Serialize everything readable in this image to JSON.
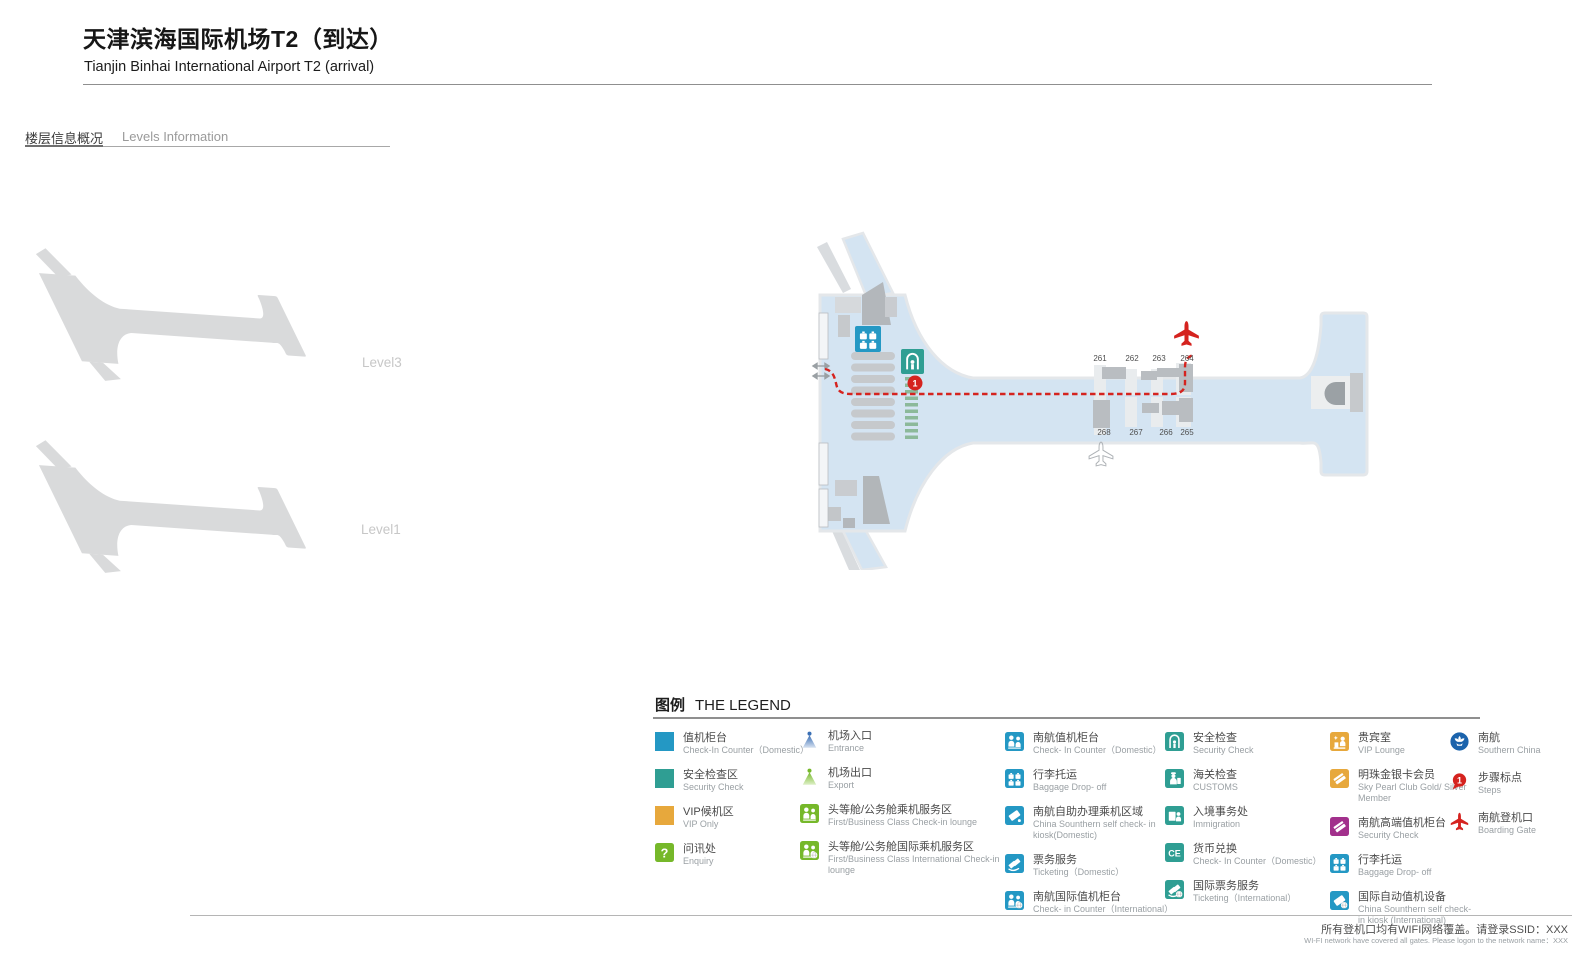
{
  "page": {
    "title_zh": "天津滨海国际机场T2（到达）",
    "title_en": "Tianjin Binhai International Airport T2 (arrival)"
  },
  "levels_section": {
    "heading_zh": "楼层信息概况",
    "heading_en": "Levels Information",
    "levels": [
      {
        "label": "Level3"
      },
      {
        "label": "Level1"
      }
    ]
  },
  "map": {
    "gates_top": [
      "261",
      "262",
      "263",
      "264"
    ],
    "gates_bottom": [
      "268",
      "267",
      "266",
      "265"
    ],
    "step_marker": "1"
  },
  "legend": {
    "title_zh": "图例",
    "title_en": "THE LEGEND",
    "columns": [
      {
        "items": [
          {
            "icon": "checkin-swatch",
            "zh": "值机柜台",
            "en": "Check-In Counter（Domestic）"
          },
          {
            "icon": "security-swatch",
            "zh": "安全检查区",
            "en": "Security Check"
          },
          {
            "icon": "vip-swatch",
            "zh": "VIP候机区",
            "en": "VIP Only"
          },
          {
            "icon": "enquiry",
            "glyph": "?",
            "zh": "问讯处",
            "en": "Enquiry"
          }
        ]
      },
      {
        "items": [
          {
            "icon": "entrance",
            "zh": "机场入口",
            "en": "Entrance"
          },
          {
            "icon": "export",
            "zh": "机场出口",
            "en": "Export"
          },
          {
            "icon": "first-class-lounge",
            "zh": "头等舱/公务舱乘机服务区",
            "en": "First/Business Class Check-in lounge"
          },
          {
            "icon": "first-class-lounge-intl",
            "zh": "头等舱/公务舱国际乘机服务区",
            "en": "First/Business Class International Check-in lounge"
          }
        ]
      },
      {
        "items": [
          {
            "icon": "people",
            "zh": "南航值机柜台",
            "en": "Check- In Counter（Domestic）"
          },
          {
            "icon": "baggage",
            "zh": "行李托运",
            "en": "Baggage Drop- off"
          },
          {
            "icon": "kiosk",
            "zh": "南航自助办理乘机区域",
            "en": "China Sounthern self check- in kiosk(Domestic)"
          },
          {
            "icon": "ticket",
            "zh": "票务服务",
            "en": "Ticketing（Domestic）"
          },
          {
            "icon": "people-intl",
            "zh": "南航国际值机柜台",
            "en": "Check- in Counter（International）"
          }
        ]
      },
      {
        "items": [
          {
            "icon": "security-arch",
            "zh": "安全检查",
            "en": "Security Check"
          },
          {
            "icon": "customs",
            "zh": "海关检查",
            "en": "CUSTOMS"
          },
          {
            "icon": "immigration",
            "zh": "入境事务处",
            "en": "Immigration"
          },
          {
            "icon": "currency-exchange",
            "glyph": "CE",
            "zh": "货币兑换",
            "en": "Check- In Counter（Domestic）"
          },
          {
            "icon": "ticket-intl",
            "zh": "国际票务服务",
            "en": "Ticketing（International）"
          }
        ]
      },
      {
        "items": [
          {
            "icon": "vip-lounge",
            "zh": "贵宾室",
            "en": "VIP Lounge"
          },
          {
            "icon": "member-card",
            "zh": "明珠金银卡会员",
            "en": "Sky Pearl Club Gold/ Silver Member"
          },
          {
            "icon": "premium-checkin-card",
            "zh": "南航高端值机柜台",
            "en": "Security Check"
          },
          {
            "icon": "baggage",
            "zh": "行李托运",
            "en": "Baggage Drop- off"
          },
          {
            "icon": "kiosk-intl",
            "zh": "国际自动值机设备",
            "en": "China Sounthern self check- in kiosk (International)"
          }
        ]
      },
      {
        "items": [
          {
            "icon": "airline-logo",
            "zh": "南航",
            "en": "Southern China"
          },
          {
            "icon": "step-pin",
            "glyph": "1",
            "zh": "步骤标点",
            "en": "Steps"
          },
          {
            "icon": "boarding-plane",
            "zh": "南航登机口",
            "en": "Boarding Gate"
          }
        ]
      }
    ]
  },
  "footer": {
    "text_zh": "所有登机口均有WIFI网络覆盖。请登录SSID：XXX",
    "text_en": "WI-FI network have covered all gates. Please logon to the network name：XXX"
  },
  "colors": {
    "blue": "#2498c4",
    "teal": "#2f9e93",
    "green": "#76b82a",
    "orange": "#e7a83c",
    "purple": "#a2308c",
    "red": "#d5231f",
    "brand_blue": "#1b63ac",
    "map_fill": "#d4e4f2",
    "map_stroke": "#e4e7ea",
    "silhouette": "#d9dadb",
    "dash_green": "#8cb99a"
  }
}
